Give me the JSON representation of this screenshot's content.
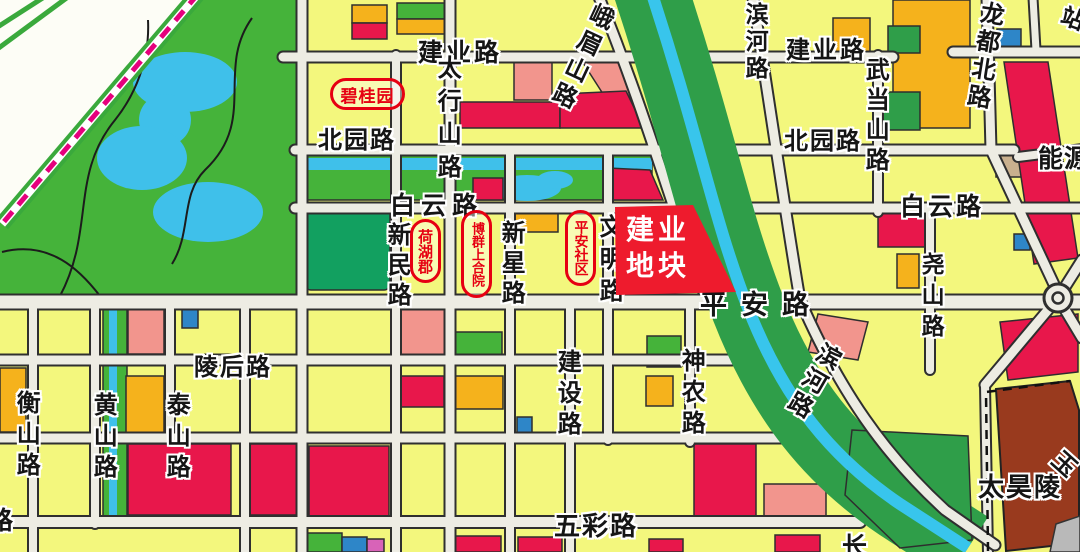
{
  "map": {
    "road_labels": {
      "jianye_w": "建业路",
      "jianye_e": "建业路",
      "beiyuan_w": "北园路",
      "beiyuan_e": "北园路",
      "baiyun_w": "白云路",
      "baiyun_e": "白云路",
      "taihangshan": "太行山路",
      "emeishan": "峨眉山路",
      "binhe_n": "滨河路",
      "binhe_s": "滨河路",
      "wudangshan": "武当山路",
      "longdu_bei": "龙都北路",
      "nengyuan_partial": "能源",
      "zhan_partial": "站",
      "xinmin": "新民路",
      "xinxing": "新星路",
      "wenming": "文明路",
      "pingan": "平安路",
      "yaoshan": "尧山路",
      "linghou": "陵后路",
      "jianshe": "建设路",
      "shennong": "神农路",
      "hengshan": "衡山路",
      "huangshan": "黄山路",
      "taishan": "泰山路",
      "wucai": "五彩路",
      "chang_partial": "长",
      "lu_partial": "路",
      "yu_partial": "玉"
    },
    "landmarks": {
      "biguiyuan": "碧桂园",
      "hehujun": "荷湖郡",
      "boqun_shangheyuan": "博群上合院",
      "pingan_shequ": "平安社区",
      "taihaoling": "太昊陵"
    },
    "highlight_parcel": {
      "line1": "建业",
      "line2": "地块"
    },
    "colors": {
      "parcel_yellow": "#f3f77d",
      "road_fill": "#edece3",
      "road_casing": "#2f2f2f",
      "park_green": "#45b33a",
      "water_blue": "#3fc0ea",
      "river_green": "#2f9e49",
      "crimson_parcel": "#e8174b",
      "salmon_parcel": "#f2958d",
      "orange_parcel": "#f5b21c",
      "dark_green_parcel": "#12a060",
      "blue_parcel": "#2e86c8",
      "tan_parcel": "#c9b08e",
      "magenta_parcel": "#d863b8",
      "grey_parcel": "#b9b9b9",
      "railway_magenta": "#e5007d",
      "highlight_red": "#ee1b2d",
      "landmark_red": "#e60012",
      "taihaoling_brown": "#993a1e"
    }
  }
}
